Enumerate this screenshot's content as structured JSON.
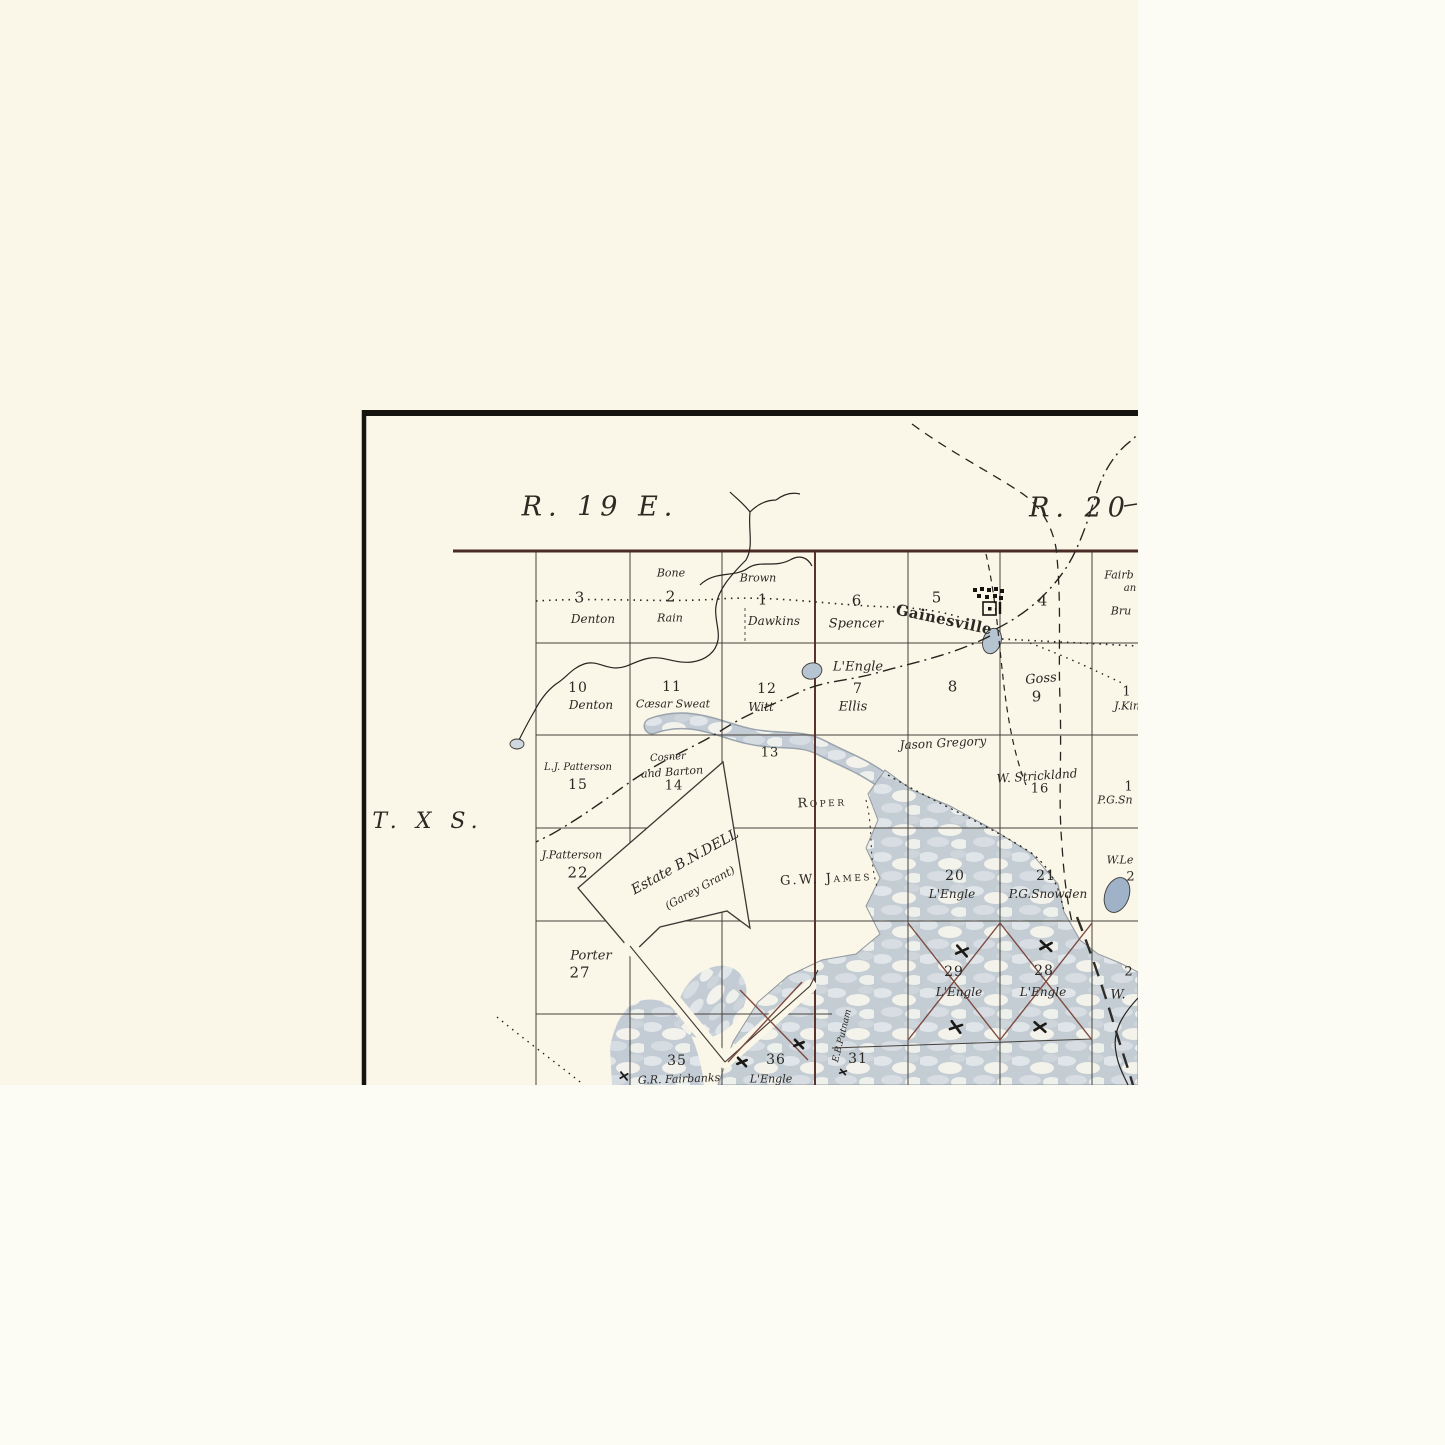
{
  "map": {
    "type_note": "historic cadastral township plat map (corner crop)",
    "palette": {
      "paper": "#faf6e8",
      "margin": "#fcfbf4",
      "ink": "#2b2824",
      "grid": "#45413a",
      "range_line": "#4a2c24",
      "maroon": "#6b3a30",
      "water": "#c3ccd4",
      "water_light": "#eef0ec",
      "pond": "#b6c3d0",
      "pond_dark": "#9fb2c8",
      "frame": "#15140f"
    },
    "icons": {
      "town_blocks": "gainesville-town-blocks-icon",
      "courthouse_square": "square-with-dot-icon",
      "cross_marks": "x-mark-icon"
    },
    "labels": [
      {
        "t": "R. 19 E.",
        "x": 600,
        "y": 507,
        "s": 27,
        "c": "h",
        "name": "range-19-east-label"
      },
      {
        "t": "R. 20",
        "x": 1080,
        "y": 508,
        "s": 27,
        "c": "h",
        "name": "range-20-label"
      },
      {
        "t": "T. X S.",
        "x": 428,
        "y": 822,
        "s": 22,
        "c": "h",
        "name": "township-10-south-label"
      },
      {
        "t": "3",
        "x": 580,
        "y": 598,
        "s": 15,
        "c": "n"
      },
      {
        "t": "Denton",
        "x": 593,
        "y": 619,
        "s": 12,
        "c": "i"
      },
      {
        "t": "Bone",
        "x": 671,
        "y": 573,
        "s": 11,
        "c": "i"
      },
      {
        "t": "2",
        "x": 671,
        "y": 597,
        "s": 15,
        "c": "n"
      },
      {
        "t": "Rain",
        "x": 670,
        "y": 618,
        "s": 11,
        "c": "i"
      },
      {
        "t": "Brown",
        "x": 758,
        "y": 578,
        "s": 11,
        "c": "i"
      },
      {
        "t": "1",
        "x": 763,
        "y": 600,
        "s": 15,
        "c": "n"
      },
      {
        "t": "Dawkins",
        "x": 774,
        "y": 621,
        "s": 12,
        "c": "i"
      },
      {
        "t": "6",
        "x": 857,
        "y": 601,
        "s": 15,
        "c": "n"
      },
      {
        "t": "Spencer",
        "x": 856,
        "y": 624,
        "s": 13,
        "c": "i"
      },
      {
        "t": "5",
        "x": 937,
        "y": 598,
        "s": 15,
        "c": "n"
      },
      {
        "t": "Gainesville",
        "x": 944,
        "y": 620,
        "s": 15,
        "c": "b",
        "r": 12,
        "name": "town-label-gainesville"
      },
      {
        "t": "4",
        "x": 1043,
        "y": 601,
        "s": 15,
        "c": "n"
      },
      {
        "t": "Fairb",
        "x": 1119,
        "y": 575,
        "s": 11,
        "c": "i"
      },
      {
        "t": "an",
        "x": 1130,
        "y": 589,
        "s": 10,
        "c": "i"
      },
      {
        "t": "Bru",
        "x": 1121,
        "y": 611,
        "s": 11,
        "c": "i"
      },
      {
        "t": "10",
        "x": 578,
        "y": 688,
        "s": 14,
        "c": "n"
      },
      {
        "t": "Denton",
        "x": 591,
        "y": 705,
        "s": 12,
        "c": "i"
      },
      {
        "t": "11",
        "x": 672,
        "y": 687,
        "s": 14,
        "c": "n"
      },
      {
        "t": "Cæsar Sweat",
        "x": 673,
        "y": 704,
        "s": 11,
        "c": "i"
      },
      {
        "t": "12",
        "x": 767,
        "y": 689,
        "s": 14,
        "c": "n"
      },
      {
        "t": "Witt",
        "x": 761,
        "y": 707,
        "s": 12,
        "c": "i"
      },
      {
        "t": "L'Engle",
        "x": 858,
        "y": 667,
        "s": 13,
        "c": "i"
      },
      {
        "t": "7",
        "x": 858,
        "y": 689,
        "s": 14,
        "c": "n"
      },
      {
        "t": "Ellis",
        "x": 853,
        "y": 707,
        "s": 13,
        "c": "i"
      },
      {
        "t": "8",
        "x": 953,
        "y": 687,
        "s": 15,
        "c": "n"
      },
      {
        "t": "Goss",
        "x": 1041,
        "y": 679,
        "s": 13,
        "c": "i",
        "r": -5
      },
      {
        "t": "9",
        "x": 1037,
        "y": 697,
        "s": 15,
        "c": "n"
      },
      {
        "t": "1",
        "x": 1127,
        "y": 692,
        "s": 13,
        "c": "n"
      },
      {
        "t": "J.Kin",
        "x": 1127,
        "y": 706,
        "s": 11,
        "c": "i"
      },
      {
        "t": "Jason Gregory",
        "x": 943,
        "y": 743,
        "s": 12,
        "c": "i",
        "r": -3
      },
      {
        "t": "L.J. Patterson",
        "x": 578,
        "y": 768,
        "s": 10,
        "c": "i"
      },
      {
        "t": "15",
        "x": 578,
        "y": 785,
        "s": 14,
        "c": "n"
      },
      {
        "t": "Cosner",
        "x": 668,
        "y": 758,
        "s": 10,
        "c": "i",
        "r": -4
      },
      {
        "t": "and Barton",
        "x": 672,
        "y": 772,
        "s": 11,
        "c": "i",
        "r": -4
      },
      {
        "t": "14",
        "x": 674,
        "y": 786,
        "s": 13,
        "c": "n"
      },
      {
        "t": "13",
        "x": 770,
        "y": 753,
        "s": 13,
        "c": "n"
      },
      {
        "t": "Roper",
        "x": 822,
        "y": 803,
        "s": 13,
        "c": "sc",
        "r": -2
      },
      {
        "t": "W. Strickland",
        "x": 1037,
        "y": 776,
        "s": 12,
        "c": "i",
        "r": -4
      },
      {
        "t": "16",
        "x": 1040,
        "y": 789,
        "s": 13,
        "c": "n"
      },
      {
        "t": "1",
        "x": 1129,
        "y": 787,
        "s": 13,
        "c": "n"
      },
      {
        "t": "P.G.Sn",
        "x": 1115,
        "y": 800,
        "s": 11,
        "c": "i"
      },
      {
        "t": "J.Patterson",
        "x": 572,
        "y": 855,
        "s": 11,
        "c": "i"
      },
      {
        "t": "22",
        "x": 578,
        "y": 873,
        "s": 15,
        "c": "n"
      },
      {
        "t": "Estate B.N.DELL",
        "x": 685,
        "y": 862,
        "s": 14,
        "c": "i",
        "r": -29,
        "name": "estate-dell-label"
      },
      {
        "t": "(Garey Grant)",
        "x": 700,
        "y": 888,
        "s": 11,
        "c": "i",
        "r": -29,
        "name": "garey-grant-label"
      },
      {
        "t": "G.W. James",
        "x": 826,
        "y": 879,
        "s": 13,
        "c": "sc",
        "r": -3
      },
      {
        "t": "20",
        "x": 955,
        "y": 876,
        "s": 14,
        "c": "n"
      },
      {
        "t": "L'Engle",
        "x": 952,
        "y": 894,
        "s": 12,
        "c": "i"
      },
      {
        "t": "21",
        "x": 1046,
        "y": 876,
        "s": 14,
        "c": "n"
      },
      {
        "t": "P.G.Snowden",
        "x": 1048,
        "y": 894,
        "s": 12,
        "c": "i"
      },
      {
        "t": "W.Le",
        "x": 1120,
        "y": 860,
        "s": 11,
        "c": "i"
      },
      {
        "t": "2",
        "x": 1131,
        "y": 877,
        "s": 13,
        "c": "n"
      },
      {
        "t": "Porter",
        "x": 591,
        "y": 956,
        "s": 13,
        "c": "i"
      },
      {
        "t": "27",
        "x": 580,
        "y": 973,
        "s": 15,
        "c": "n"
      },
      {
        "t": "29",
        "x": 954,
        "y": 972,
        "s": 14,
        "c": "n"
      },
      {
        "t": "L'Engle",
        "x": 959,
        "y": 992,
        "s": 12,
        "c": "i"
      },
      {
        "t": "28",
        "x": 1044,
        "y": 971,
        "s": 14,
        "c": "n"
      },
      {
        "t": "L'Engle",
        "x": 1043,
        "y": 992,
        "s": 12,
        "c": "i"
      },
      {
        "t": "2",
        "x": 1129,
        "y": 972,
        "s": 13,
        "c": "n"
      },
      {
        "t": "W.",
        "x": 1118,
        "y": 995,
        "s": 13,
        "c": "i"
      },
      {
        "t": "35",
        "x": 677,
        "y": 1061,
        "s": 14,
        "c": "n"
      },
      {
        "t": "G.R. Fairbanks",
        "x": 679,
        "y": 1079,
        "s": 11,
        "c": "i",
        "r": -2
      },
      {
        "t": "36",
        "x": 776,
        "y": 1060,
        "s": 14,
        "c": "n"
      },
      {
        "t": "L'Engle",
        "x": 771,
        "y": 1079,
        "s": 11,
        "c": "i"
      },
      {
        "t": "31",
        "x": 858,
        "y": 1059,
        "s": 14,
        "c": "n"
      },
      {
        "t": "E.B.Putnam",
        "x": 843,
        "y": 1036,
        "s": 9,
        "c": "i",
        "r": -76,
        "name": "putnam-vertical-label"
      }
    ]
  }
}
